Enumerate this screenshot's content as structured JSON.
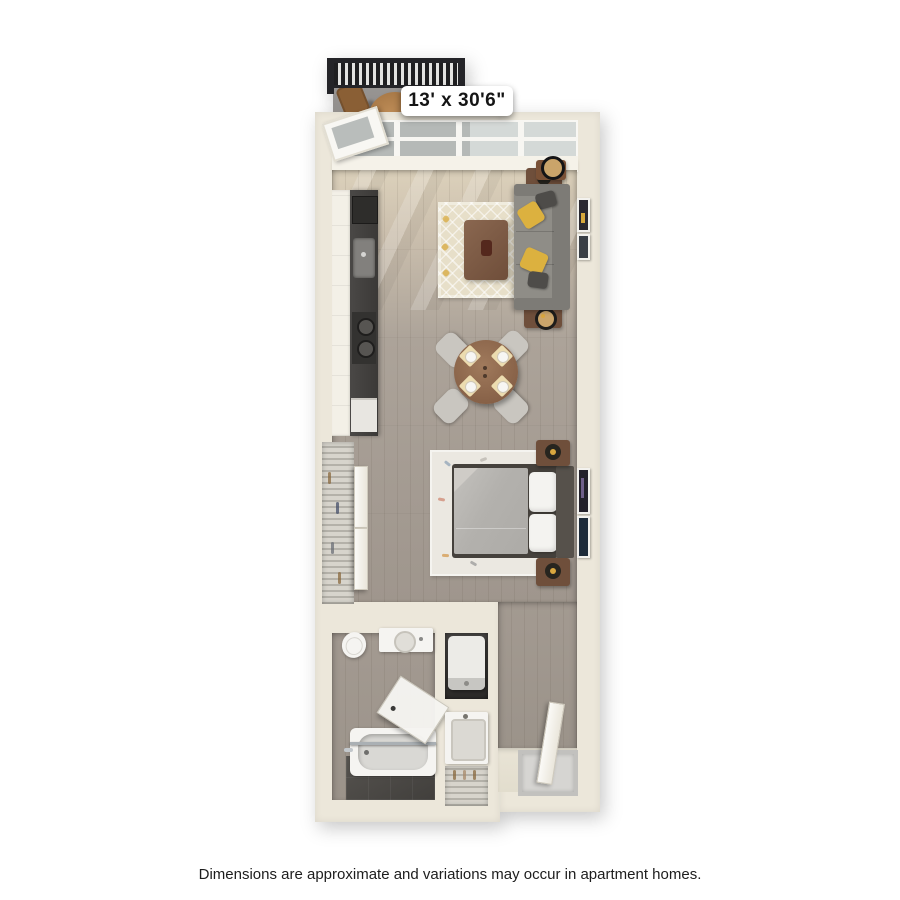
{
  "page": {
    "background": "#ffffff",
    "disclaimer": "Dimensions are approximate and variations may occur in apartment homes."
  },
  "floorplan": {
    "dimension_label": "13' x 30'6\"",
    "unit_type": "studio-apartment-3d-floor-plan",
    "rooms": [
      "balcony",
      "kitchen",
      "living-dining-area",
      "sleeping-area",
      "walk-in-closet",
      "bathroom",
      "laundry-closet",
      "linen-closet",
      "entry"
    ],
    "furniture": [
      "patio-railing",
      "patio-table",
      "patio-chairs",
      "balcony-door",
      "window-wall",
      "kitchen-cabinets",
      "kitchen-counter",
      "kitchen-sink",
      "cooktop",
      "sofa",
      "throw-pillows",
      "end-tables",
      "coffee-table",
      "living-rug",
      "wall-art",
      "dining-table",
      "dining-chairs",
      "place-settings",
      "bed",
      "bed-pillows",
      "headboard",
      "nightstands",
      "lamps",
      "bedroom-rug",
      "wire-shelving",
      "sliding-closet-doors",
      "toilet",
      "vanity-sink",
      "bathtub",
      "shower-door",
      "washer-dryer",
      "second-sink",
      "door-mat",
      "entry-door"
    ],
    "colors": {
      "wall": "#ece7da",
      "floor_wood_light": "#dcd1bb",
      "floor_wood_gray": "#a49b92",
      "balcony_floor": "#8f8d8a",
      "railing": "#242428",
      "sofa": "#8f8d87",
      "accent_pillow_yellow": "#dcb13f",
      "wood_furniture_brown": "#7a5a42",
      "bath_tile_dark": "#4a4846",
      "living_rug": "#e7dfc9",
      "bedroom_rug": "#ebe8e1",
      "glass": "#c3c7c5"
    }
  }
}
